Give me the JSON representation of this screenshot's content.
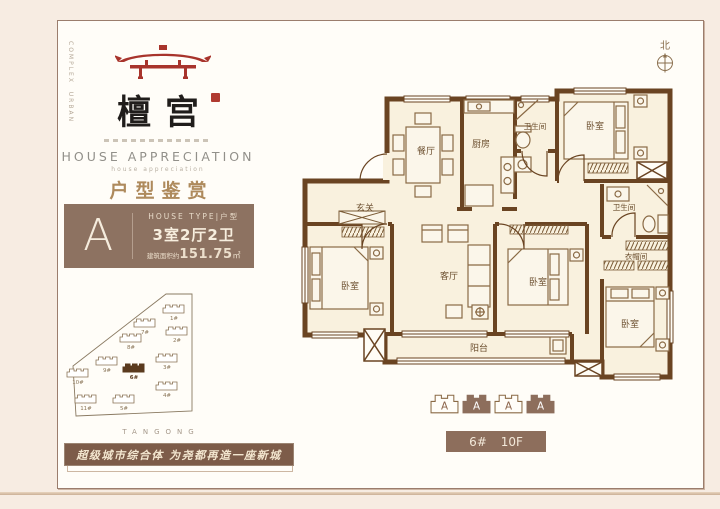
{
  "page": {
    "side_text_col1": "URBAN",
    "side_text_col2": "COMPLEX",
    "compass_label": "北"
  },
  "brand": {
    "logo_name": "檀宫",
    "section_title_en": "HOUSE APPRECIATION",
    "section_subtitle_en": "house appreciation",
    "section_title_cn": "户型鉴赏",
    "project_name_spaced": "TANGONG",
    "slogan": "超级城市综合体 为尧都再造一座新城"
  },
  "house_type": {
    "letter": "A",
    "type_label": "HOUSE TYPE|户型",
    "layout": "3室2厅2卫",
    "area_prefix": "建筑面积约",
    "area_value": "151.75",
    "area_unit": "㎡"
  },
  "site_map": {
    "buildings": [
      {
        "id": "1#"
      },
      {
        "id": "7#"
      },
      {
        "id": "2#"
      },
      {
        "id": "8#"
      },
      {
        "id": "9#"
      },
      {
        "id": "3#"
      },
      {
        "id": "6#",
        "highlight": true
      },
      {
        "id": "10#"
      },
      {
        "id": "4#"
      },
      {
        "id": "11#"
      },
      {
        "id": "5#"
      }
    ]
  },
  "floor_plan": {
    "rooms": [
      {
        "label": "餐厅"
      },
      {
        "label": "厨房"
      },
      {
        "label": "卫生间"
      },
      {
        "label": "卧室"
      },
      {
        "label": "玄关"
      },
      {
        "label": "卧室"
      },
      {
        "label": "客厅"
      },
      {
        "label": "卧室"
      },
      {
        "label": "卫生间"
      },
      {
        "label": "衣帽间"
      },
      {
        "label": "卧室"
      },
      {
        "label": "阳台"
      }
    ]
  },
  "units_row": [
    "A",
    "A",
    "A",
    "A"
  ],
  "location_tag": {
    "building": "6#",
    "floor": "10F"
  },
  "colors": {
    "wall_brown": "#6a4422",
    "accent_red": "#a8342c",
    "gold": "#ae8a5c",
    "box_brown": "#8d7261",
    "banner_brown": "#7d5c49",
    "bar_brown": "#8d6e5c",
    "map_highlight": "#5a3a1e",
    "page_bg": "#f7ece2"
  }
}
